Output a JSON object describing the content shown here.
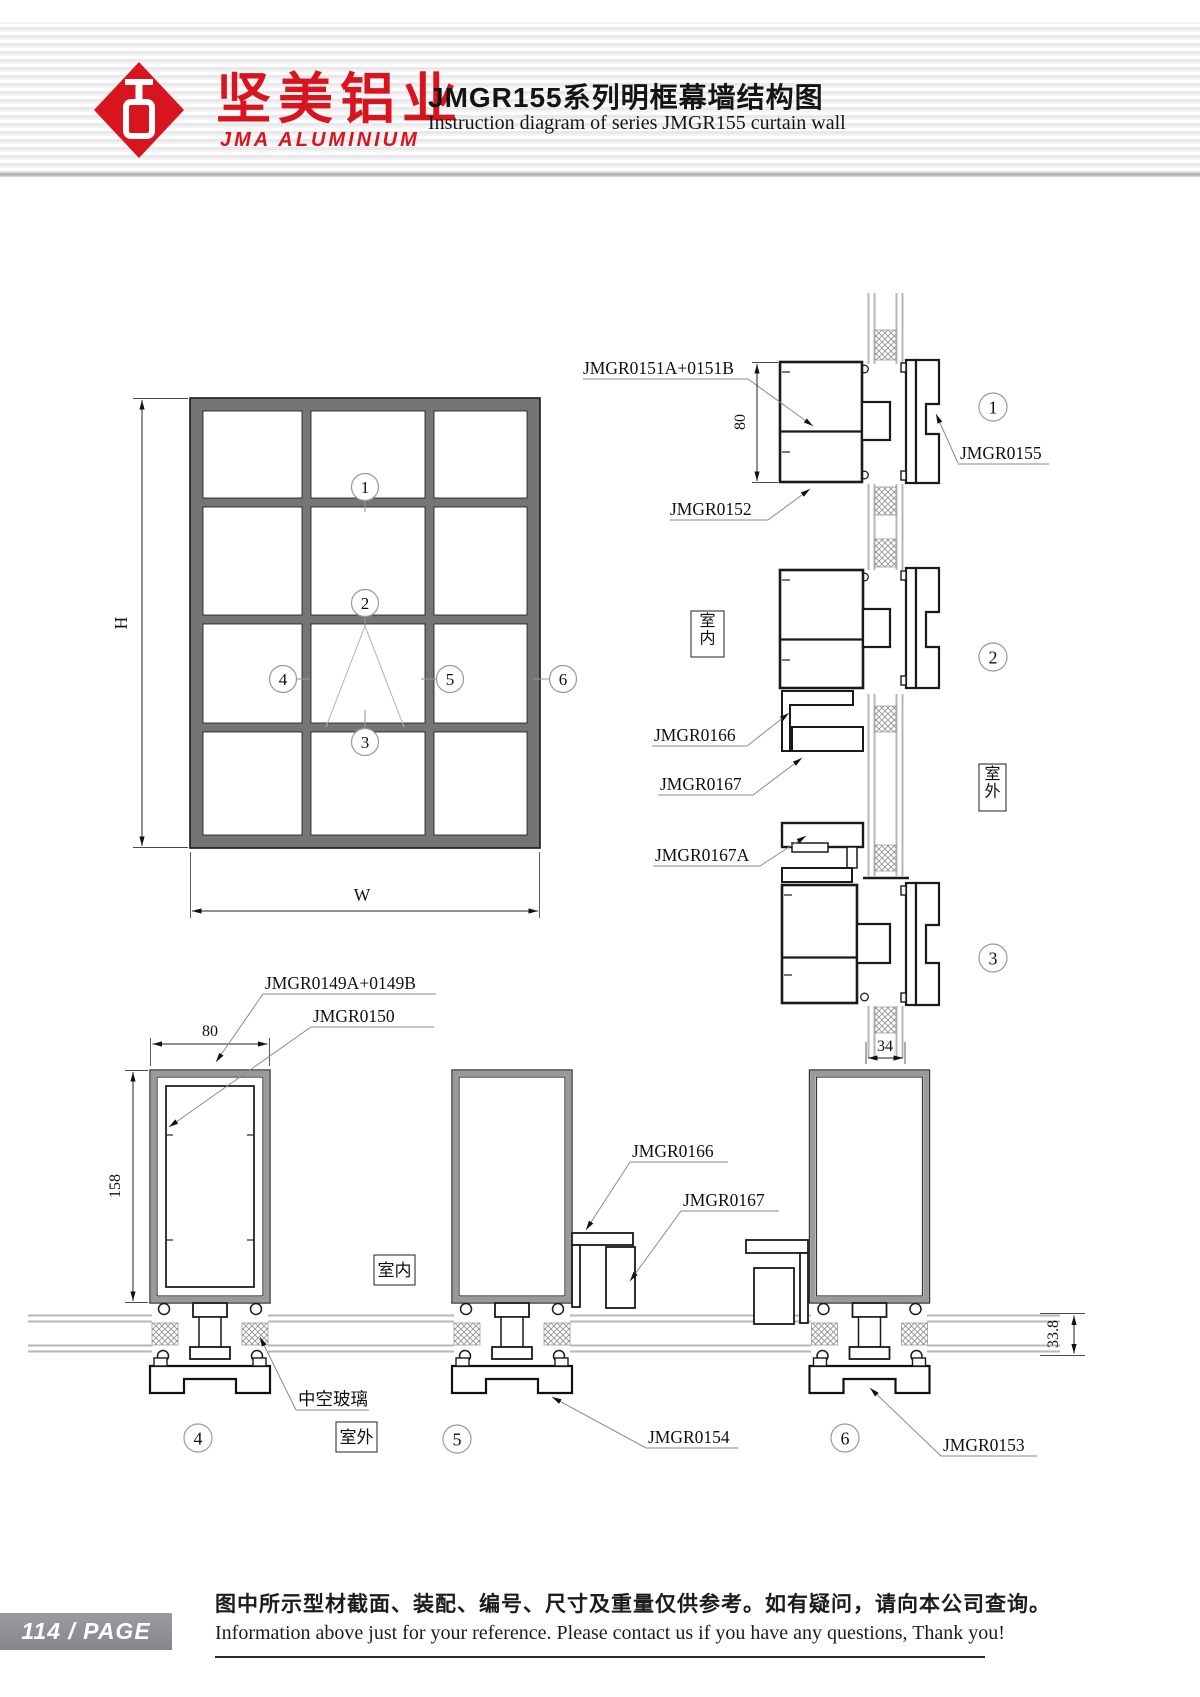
{
  "header": {
    "brand_cn": "坚美铝业",
    "brand_en": "JMA ALUMINIUM",
    "title_cn": "JMGR155系列明框幕墙结构图",
    "title_en": "Instruction diagram of series JMGR155 curtain wall"
  },
  "elevation": {
    "dim_height": "H",
    "dim_width": "W",
    "markers": [
      "1",
      "2",
      "3",
      "4",
      "5",
      "6"
    ]
  },
  "right_column": {
    "label_151": "JMGR0151A+0151B",
    "label_152": "JMGR0152",
    "label_155": "JMGR0155",
    "dim_80": "80",
    "indoor": "室内",
    "label_166": "JMGR0166",
    "label_167": "JMGR0167",
    "outdoor": "室外",
    "label_167a": "JMGR0167A",
    "dim_34": "34"
  },
  "bottom_row": {
    "label_149": "JMGR0149A+0149B",
    "label_150": "JMGR0150",
    "dim_80": "80",
    "dim_158": "158",
    "indoor": "室内",
    "glass": "中空玻璃",
    "outdoor": "室外",
    "label_166": "JMGR0166",
    "label_167": "JMGR0167",
    "label_154": "JMGR0154",
    "label_153": "JMGR0153",
    "dim_338": "33.8"
  },
  "footer": {
    "page": "114 / PAGE",
    "note_cn": "图中所示型材截面、装配、编号、尺寸及重量仅供参考。如有疑问，请向本公司查询。",
    "note_en": "Information above just for your reference. Please contact us if you have any questions, Thank you!"
  },
  "colors": {
    "brand_red": "#d8141e",
    "line": "#1a1a1a",
    "glass_gray": "#b7b7b9",
    "frame_gray": "#757578",
    "badge_gray": "#8e8e92"
  }
}
